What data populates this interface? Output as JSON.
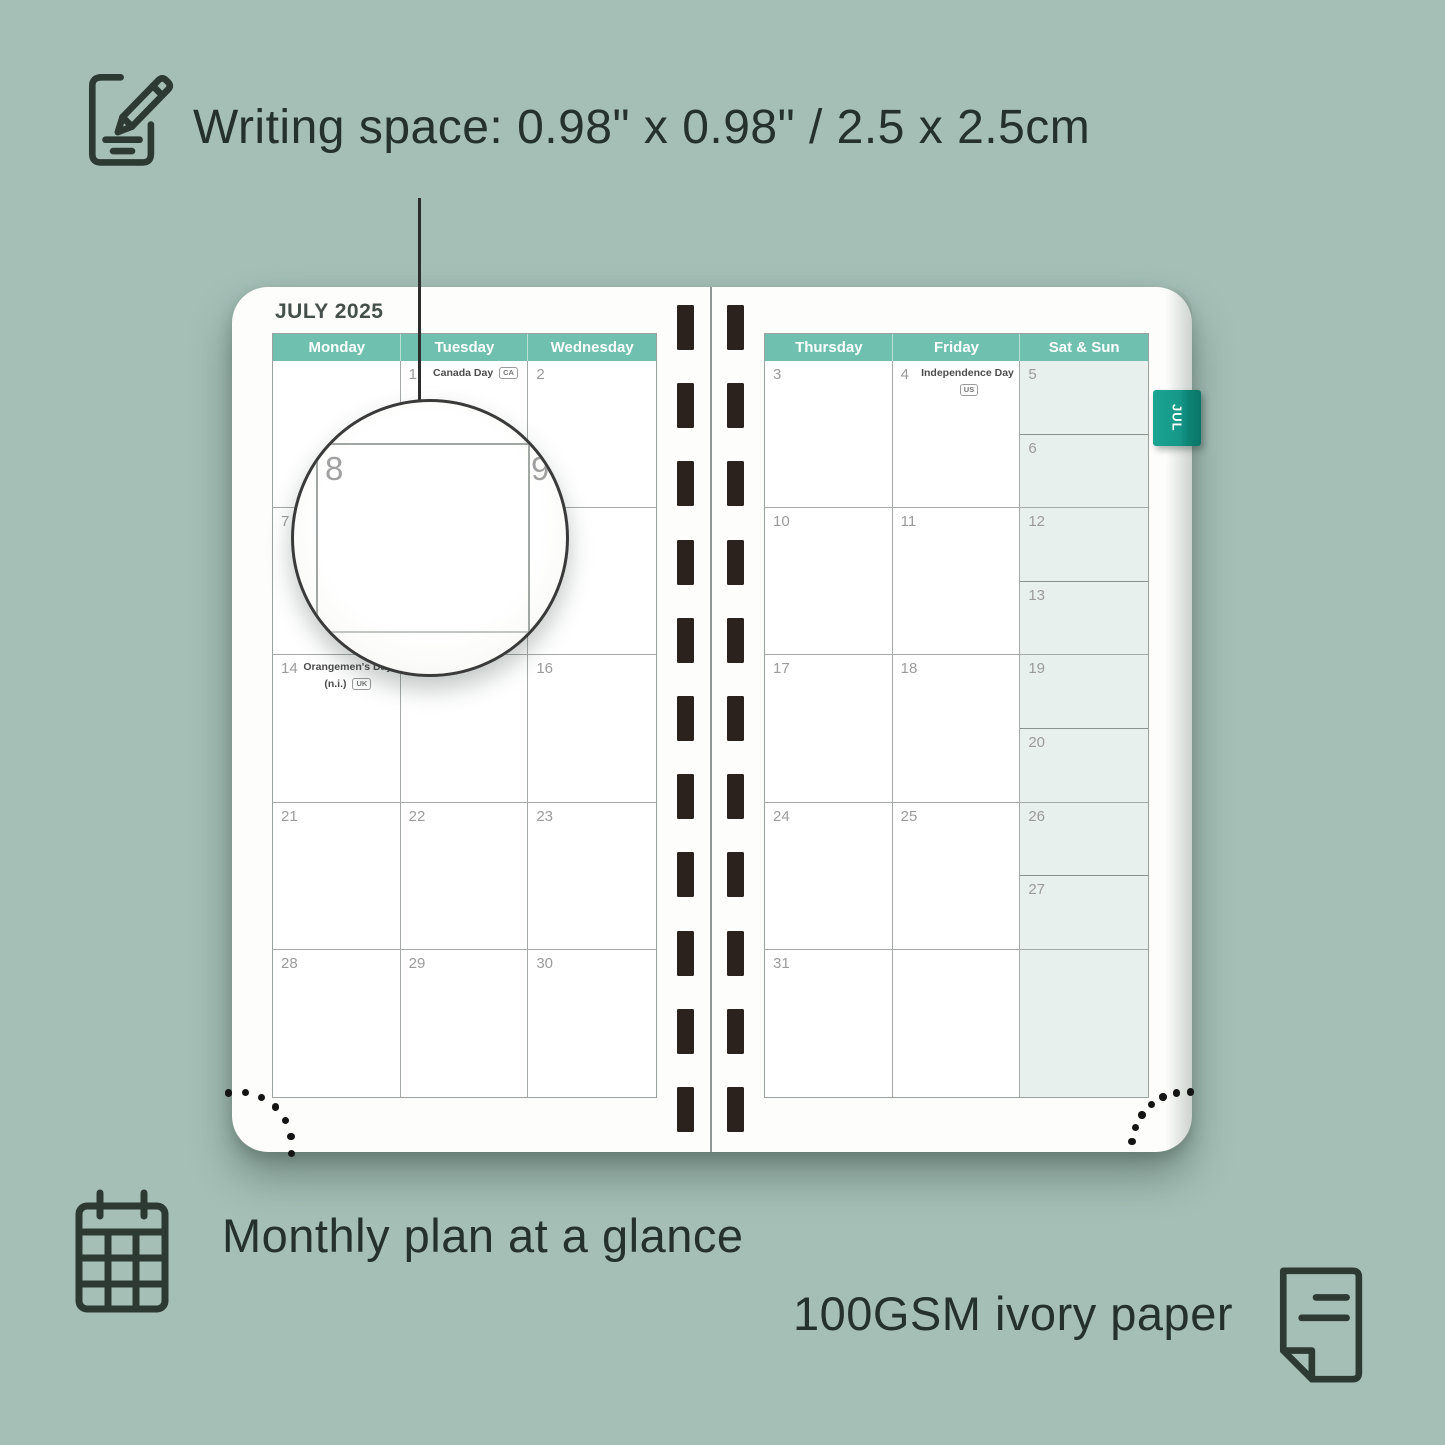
{
  "features": {
    "writing_space": "Writing space: 0.98\" x 0.98\" / 2.5 x 2.5cm",
    "monthly_plan": "Monthly plan at a glance",
    "paper": "100GSM ivory paper"
  },
  "planner": {
    "month_title": "JULY 2025",
    "tab_label": "JUL",
    "left_page": {
      "headers": [
        "Monday",
        "Tuesday",
        "Wednesday"
      ],
      "rows": [
        [
          {
            "num": ""
          },
          {
            "num": "1",
            "holiday": "Canada Day",
            "badge": "CA"
          },
          {
            "num": "2"
          }
        ],
        [
          {
            "num": "7"
          },
          {
            "num": ""
          },
          {
            "num": ""
          }
        ],
        [
          {
            "num": "14",
            "holiday": "Orangemen's Day",
            "holiday2": "(n.i.)",
            "badge": "UK"
          },
          {
            "num": ""
          },
          {
            "num": "16"
          }
        ],
        [
          {
            "num": "21"
          },
          {
            "num": "22"
          },
          {
            "num": "23"
          }
        ],
        [
          {
            "num": "28"
          },
          {
            "num": "29"
          },
          {
            "num": "30"
          }
        ]
      ]
    },
    "right_page": {
      "headers": [
        "Thursday",
        "Friday",
        "Sat & Sun"
      ],
      "rows": [
        [
          {
            "num": "3"
          },
          {
            "num": "4",
            "holiday": "Independence Day",
            "badge": "US"
          },
          {
            "sat": "5",
            "sun": "6"
          }
        ],
        [
          {
            "num": "10"
          },
          {
            "num": "11"
          },
          {
            "sat": "12",
            "sun": "13"
          }
        ],
        [
          {
            "num": "17"
          },
          {
            "num": "18"
          },
          {
            "sat": "19",
            "sun": "20"
          }
        ],
        [
          {
            "num": "24"
          },
          {
            "num": "25"
          },
          {
            "sat": "26",
            "sun": "27"
          }
        ],
        [
          {
            "num": "31"
          },
          {
            "num": ""
          },
          {
            "sat": ""
          }
        ]
      ]
    },
    "magnifier": {
      "left_number": "8",
      "right_number": "9"
    }
  },
  "colors": {
    "background": "#a5bfb7",
    "header_teal": "#6fc0ae",
    "tab_teal": "#14998a",
    "weekend_bg": "#e7f0ec",
    "binding_dark": "#2b211d",
    "text_dark": "#24312c"
  }
}
